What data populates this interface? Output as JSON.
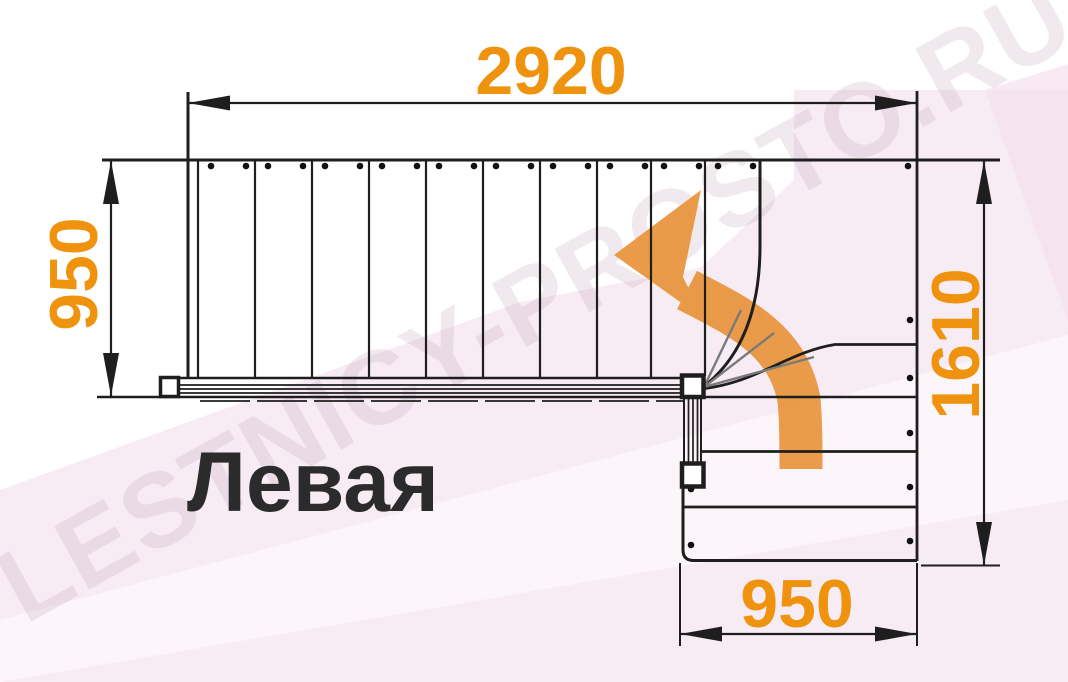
{
  "drawing": {
    "title": "Левая",
    "watermark": "LESTNICY-PROSTO.RU",
    "dimensions": {
      "total_length_mm": "2920",
      "upper_flight_width_mm": "950",
      "lower_section_length_mm": "1610",
      "lower_flight_width_mm": "950"
    },
    "staircase": {
      "description": "L-shaped staircase plan, left turn (top view)",
      "straight_treads_upper_flight": 10,
      "winder_treads": 3,
      "lower_flight_treads": 4
    },
    "colors": {
      "dimension_text": "#EF930E",
      "direction_arrow": "#E8943C",
      "linework": "#1E1E1E",
      "title_text": "#2B2B2B",
      "background_tint": "#F8ECF4"
    }
  }
}
